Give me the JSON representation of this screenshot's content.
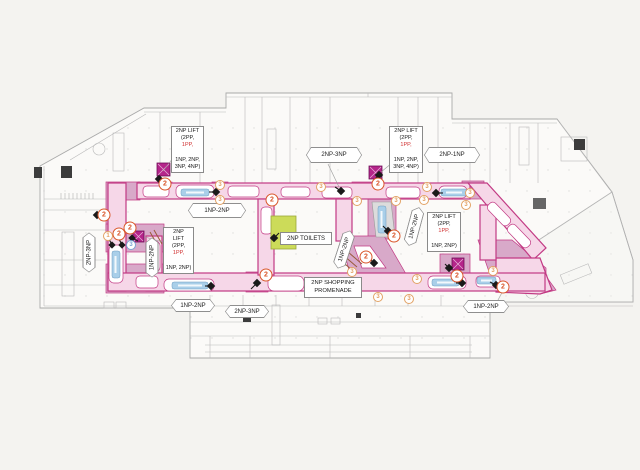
{
  "colors": {
    "pageBg": "#f4f3f0",
    "promStroke": "#c23a84",
    "promFill": "#f6d7e8",
    "zoneFill": "#d8a9c9",
    "liftFill": "#b5258a",
    "toiletsFill": "#ccdb59",
    "escFill": "#a9cfe9",
    "stairBrown": "#9a5a3a",
    "redTxt": "#d03030",
    "c2": "#d9572b",
    "c3": "#e2a264",
    "cBlue": "#7aa4d4"
  },
  "labels": {
    "toilets": {
      "text": "2NP TOILETS"
    },
    "promenade": {
      "line1": "2NP SHOPPING",
      "line2": "PROMENADE"
    }
  },
  "lift_boxes": [
    {
      "id": "lift-label-top-left",
      "x": 171,
      "y": 126,
      "w": 33,
      "h": 33,
      "lines": [
        "2NP LIFT",
        "(2PP, 1PP,",
        "1NP, 2NP,",
        "3NP, 4NP)"
      ],
      "red": "1PP,"
    },
    {
      "id": "lift-label-top-center",
      "x": 389,
      "y": 126,
      "w": 34,
      "h": 38,
      "lines": [
        "2NP LIFT",
        "(2PP, 1PP,",
        "1NP, 2NP,",
        "3NP, 4NP)"
      ],
      "red": "1PP,"
    },
    {
      "id": "lift-label-right",
      "x": 427,
      "y": 212,
      "w": 34,
      "h": 28,
      "lines": [
        "2NP LIFT",
        "(2PP, 1PP,",
        "1NP, 2NP)"
      ],
      "red": "1PP,"
    },
    {
      "id": "lift-label-left",
      "x": 163,
      "y": 227,
      "w": 31,
      "h": 37,
      "lines": [
        "2NP",
        "LIFT",
        "(2PP, 1PP,",
        "1NP, 2NP)"
      ],
      "red": "1PP,"
    }
  ],
  "level_tags": [
    {
      "text": "2NP-3NP",
      "x": 306,
      "y": 147,
      "w": 56,
      "h": 16,
      "rot": 0
    },
    {
      "text": "2NP-1NP",
      "x": 424,
      "y": 147,
      "w": 56,
      "h": 16,
      "rot": 0
    },
    {
      "text": "1NP-2NP",
      "x": 188,
      "y": 203,
      "w": 58,
      "h": 15,
      "rot": 0
    },
    {
      "text": "1NP-2NP",
      "x": 171,
      "y": 299,
      "w": 44,
      "h": 13,
      "rot": 0
    },
    {
      "text": "2NP-3NP",
      "x": 225,
      "y": 305,
      "w": 44,
      "h": 13,
      "rot": 0
    },
    {
      "text": "1NP-2NP",
      "x": 463,
      "y": 300,
      "w": 46,
      "h": 13,
      "rot": 0
    },
    {
      "text": "2NP-3NP",
      "x": 69,
      "y": 246,
      "w": 40,
      "h": 13,
      "rot": -90
    },
    {
      "text": "1NP-2NP",
      "x": 132,
      "y": 251,
      "w": 40,
      "h": 13,
      "rot": -90
    },
    {
      "text": "1NP-2NP",
      "x": 324,
      "y": 243,
      "w": 40,
      "h": 13,
      "rot": -72
    },
    {
      "text": "1NP-2NP",
      "x": 394,
      "y": 220,
      "w": 40,
      "h": 13,
      "rot": -75
    }
  ],
  "circles": [
    {
      "n": "2",
      "x": 165,
      "y": 184,
      "v": "a"
    },
    {
      "n": "3",
      "x": 220,
      "y": 185,
      "v": "b"
    },
    {
      "n": "3",
      "x": 220,
      "y": 200,
      "v": "b"
    },
    {
      "n": "2",
      "x": 272,
      "y": 200,
      "v": "a"
    },
    {
      "n": "3",
      "x": 321,
      "y": 187,
      "v": "b"
    },
    {
      "n": "2",
      "x": 378,
      "y": 184,
      "v": "a"
    },
    {
      "n": "3",
      "x": 357,
      "y": 201,
      "v": "b"
    },
    {
      "n": "3",
      "x": 396,
      "y": 201,
      "v": "b"
    },
    {
      "n": "3",
      "x": 427,
      "y": 187,
      "v": "b"
    },
    {
      "n": "3",
      "x": 424,
      "y": 200,
      "v": "b"
    },
    {
      "n": "3",
      "x": 470,
      "y": 193,
      "v": "b"
    },
    {
      "n": "3",
      "x": 466,
      "y": 205,
      "v": "b"
    },
    {
      "n": "2",
      "x": 394,
      "y": 236,
      "v": "a"
    },
    {
      "n": "2",
      "x": 104,
      "y": 215,
      "v": "a"
    },
    {
      "n": "1",
      "x": 108,
      "y": 236,
      "v": "b"
    },
    {
      "n": "2",
      "x": 119,
      "y": 234,
      "v": "a"
    },
    {
      "n": "2",
      "x": 130,
      "y": 228,
      "v": "a"
    },
    {
      "n": "3",
      "x": 131,
      "y": 245,
      "v": "c"
    },
    {
      "n": "2",
      "x": 266,
      "y": 275,
      "v": "a"
    },
    {
      "n": "2",
      "x": 366,
      "y": 257,
      "v": "a"
    },
    {
      "n": "3",
      "x": 352,
      "y": 272,
      "v": "b"
    },
    {
      "n": "3",
      "x": 378,
      "y": 297,
      "v": "b"
    },
    {
      "n": "3",
      "x": 417,
      "y": 279,
      "v": "b"
    },
    {
      "n": "3",
      "x": 409,
      "y": 299,
      "v": "b"
    },
    {
      "n": "3",
      "x": 493,
      "y": 271,
      "v": "b"
    },
    {
      "n": "2",
      "x": 503,
      "y": 287,
      "v": "a"
    },
    {
      "n": "2",
      "x": 457,
      "y": 276,
      "v": "a"
    }
  ]
}
